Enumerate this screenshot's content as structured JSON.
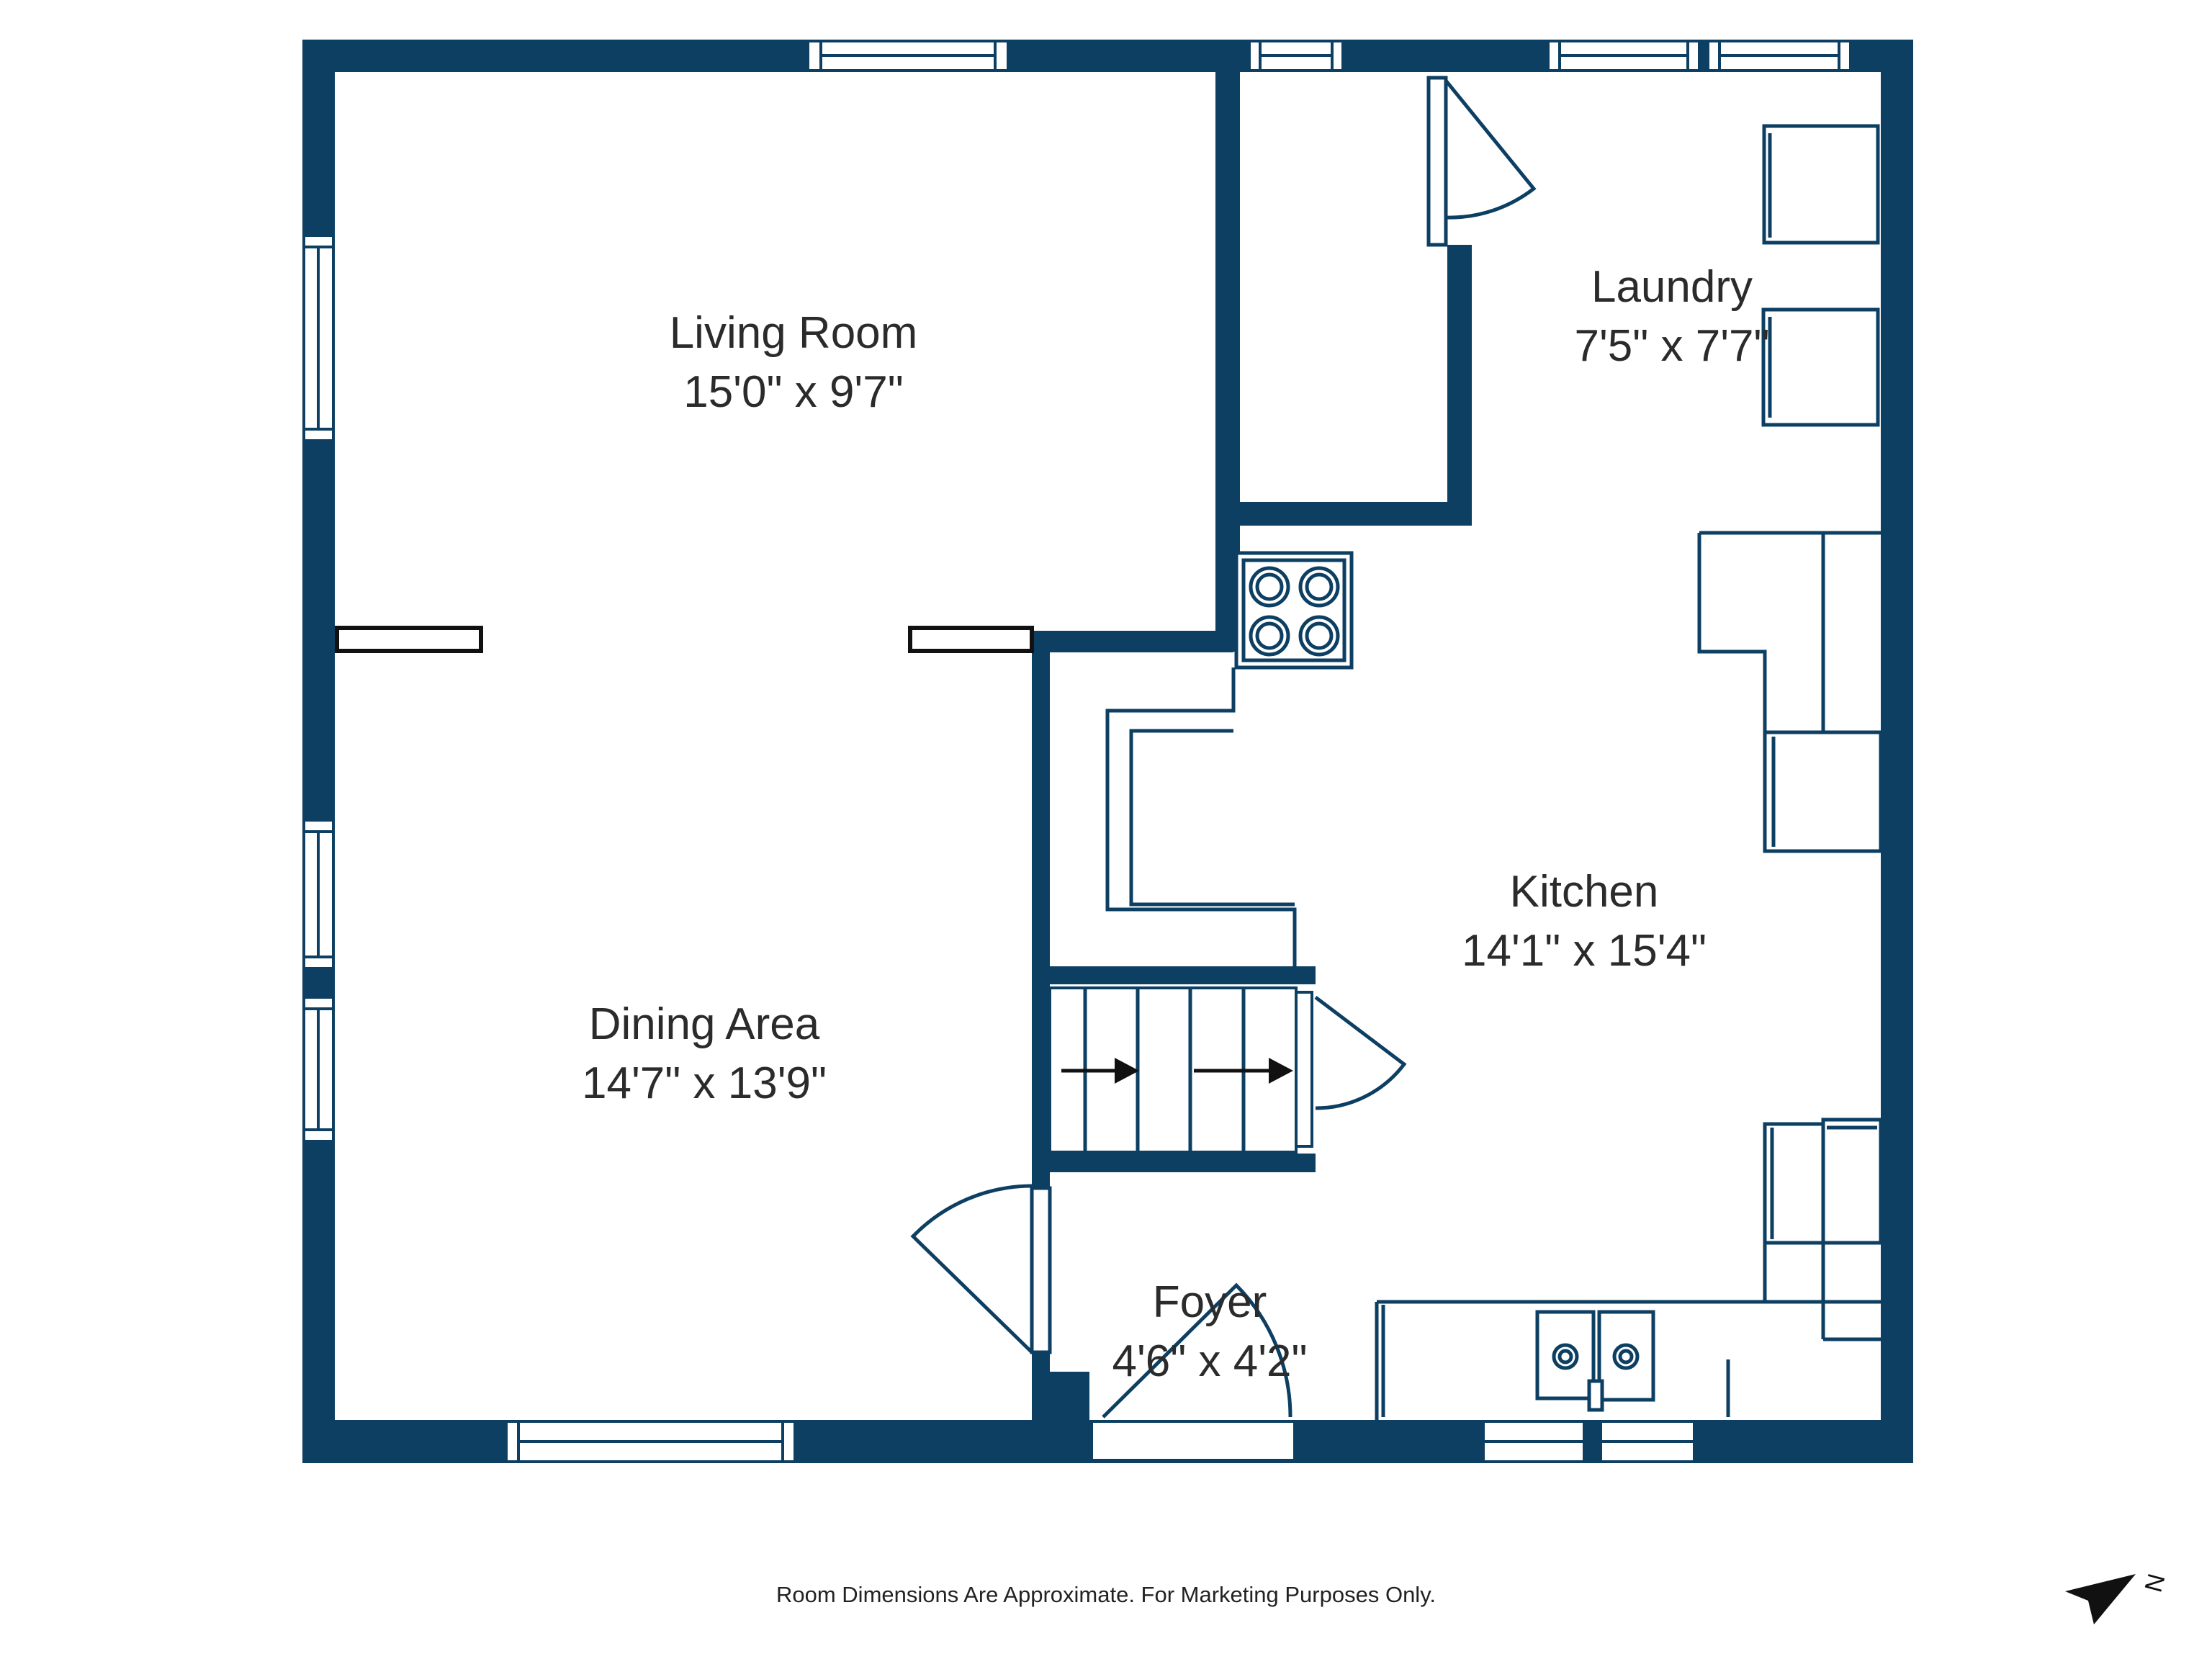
{
  "colors": {
    "wall": "#0d3f63",
    "text": "#2b2b2b",
    "black": "#111111",
    "background": "#ffffff"
  },
  "rooms": {
    "living": {
      "name": "Living Room",
      "dims": "15'0\" x 9'7\""
    },
    "laundry": {
      "name": "Laundry",
      "dims": "7'5\" x 7'7\""
    },
    "kitchen": {
      "name": "Kitchen",
      "dims": "14'1\" x 15'4\""
    },
    "dining": {
      "name": "Dining Area",
      "dims": "14'7\" x 13'9\""
    },
    "foyer": {
      "name": "Foyer",
      "dims": "4'6\" x 4'2\""
    }
  },
  "footer": {
    "disclaimer": "Room Dimensions Are Approximate. For Marketing Purposes Only."
  },
  "compass": {
    "label": "N"
  }
}
